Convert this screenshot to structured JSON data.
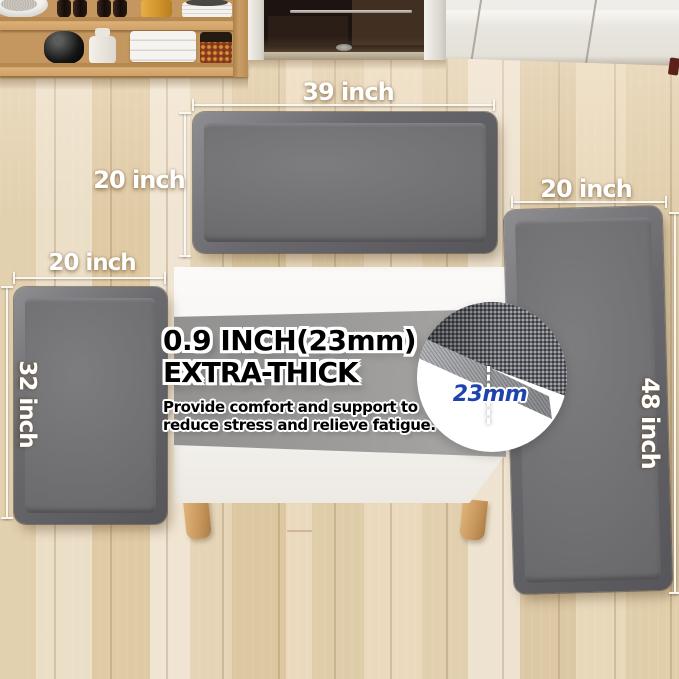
{
  "labels": {
    "top_mat_width": "39 inch",
    "top_mat_height": "20 inch",
    "left_mat_width": "20 inch",
    "left_mat_height": "32 inch",
    "right_mat_width": "20 inch",
    "right_mat_height": "48 inch"
  },
  "thickness_callout": {
    "heading_line1": "0.9 INCH(23mm)",
    "heading_line2": "EXTRA-THICK",
    "body_line1": "Provide comfort and support to",
    "body_line2": "reduce stress and relieve fatigue.",
    "detail_measure": "23mm"
  },
  "colors": {
    "mat_gray": "#6f6f72",
    "mat_bevel": "#8a8a8d",
    "detail_blue": "#1e43ae",
    "label_white": "#ffffff",
    "heading_black": "#000000",
    "floor_wood": "#e6d7b9",
    "shelf_wood": "#c49760",
    "table_white": "#f6f4f0",
    "band_gray": "#9b9a98"
  }
}
